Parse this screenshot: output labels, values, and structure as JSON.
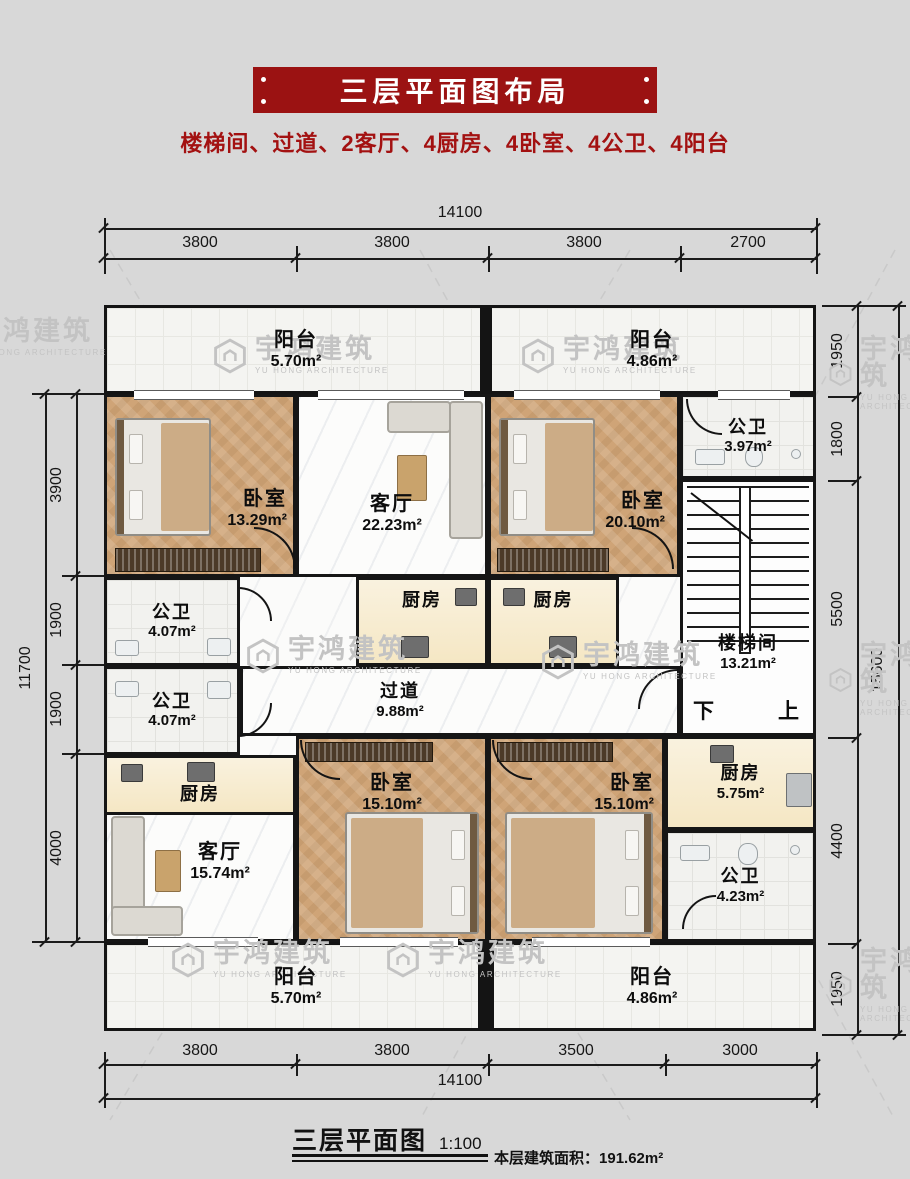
{
  "header": {
    "title": "三层平面图布局",
    "subtitle": "楼梯间、过道、2客厅、4厨房、4卧室、4公卫、4阳台"
  },
  "watermark": {
    "cn": "宇鸿建筑",
    "en": "YU HONG ARCHITECTURE"
  },
  "dimensions": {
    "top": {
      "total": "14100",
      "segments": [
        "3800",
        "3800",
        "3800",
        "2700"
      ]
    },
    "bottom": {
      "total": "14100",
      "segments": [
        "3800",
        "3800",
        "3500",
        "3000"
      ]
    },
    "left": {
      "total": "11700",
      "segments": [
        "3900",
        "1900",
        "1900",
        "4000"
      ]
    },
    "right": {
      "total": "15600",
      "segments": [
        "1950",
        "1800",
        "5500",
        "4400",
        "1950"
      ]
    }
  },
  "rooms": {
    "balcony_top_left": {
      "label": "阳台",
      "area": "5.70m²"
    },
    "balcony_top_right": {
      "label": "阳台",
      "area": "4.86m²"
    },
    "bedroom_top_left": {
      "label": "卧室",
      "area": "13.29m²"
    },
    "living_top": {
      "label": "客厅",
      "area": "22.23m²"
    },
    "bedroom_top_right": {
      "label": "卧室",
      "area": "20.10m²"
    },
    "bath_top_right": {
      "label": "公卫",
      "area": "3.97m²"
    },
    "stairwell": {
      "label": "楼梯间",
      "area": "13.21m²",
      "down": "下",
      "up": "上"
    },
    "bath_mid_upper": {
      "label": "公卫",
      "area": "4.07m²"
    },
    "bath_mid_lower": {
      "label": "公卫",
      "area": "4.07m²"
    },
    "kitchen_mid_left": {
      "label": "厨房"
    },
    "kitchen_mid_right": {
      "label": "厨房"
    },
    "corridor": {
      "label": "过道",
      "area": "9.88m²"
    },
    "kitchen_bottom_left": {
      "label": "厨房"
    },
    "living_bottom": {
      "label": "客厅",
      "area": "15.74m²"
    },
    "bedroom_bottom_left": {
      "label": "卧室",
      "area": "15.10m²"
    },
    "bedroom_bottom_right": {
      "label": "卧室",
      "area": "15.10m²"
    },
    "kitchen_bottom_right": {
      "label": "厨房",
      "area": "5.75m²"
    },
    "bath_bottom_right": {
      "label": "公卫",
      "area": "4.23m²"
    },
    "balcony_bottom_left": {
      "label": "阳台",
      "area": "5.70m²"
    },
    "balcony_bottom_right": {
      "label": "阳台",
      "area": "4.86m²"
    }
  },
  "footer": {
    "title": "三层平面图",
    "scale": "1:100",
    "area_label": "本层建筑面积：",
    "area_value": "191.62m²"
  }
}
